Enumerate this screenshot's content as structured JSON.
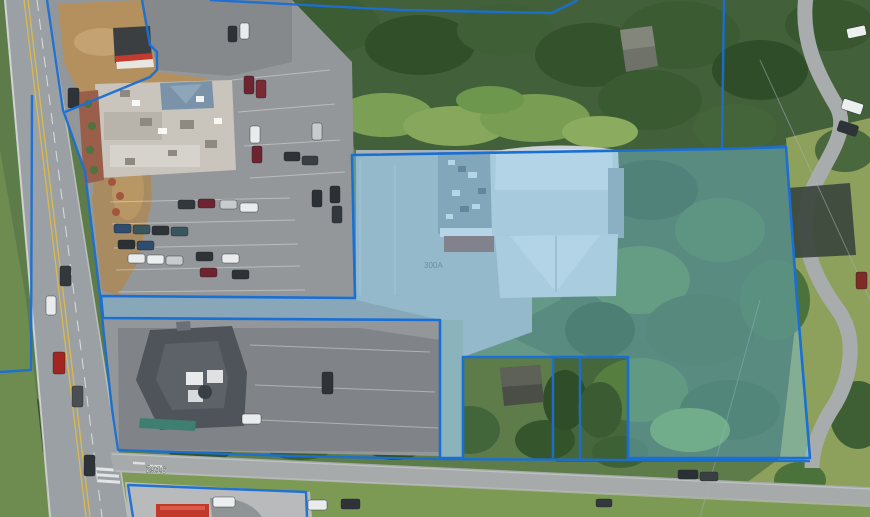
{
  "view": {
    "type": "satellite-parcel-map",
    "description": "Aerial imagery with GIS parcel boundary overlay and one highlighted parcel"
  },
  "overlay": {
    "boundary_color": "#1a6fd4",
    "highlight_fill": "rgba(118,196,233,0.40)",
    "highlight_stroke": "#1a6fd4"
  },
  "labels": {
    "street_number": "2916",
    "lot_marking": "300A"
  }
}
